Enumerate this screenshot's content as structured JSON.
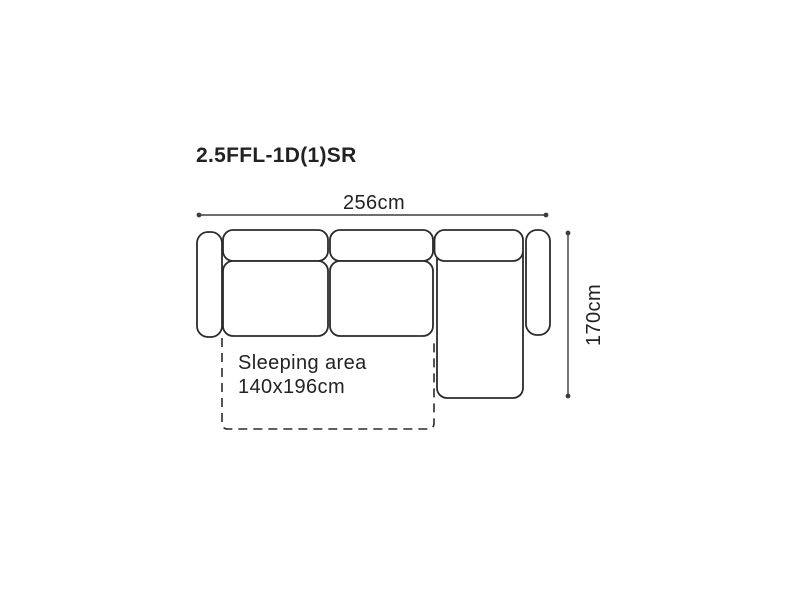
{
  "colors": {
    "background": "#ffffff",
    "outline": "#2b2b2b",
    "dimension": "#3d3d3d",
    "text": "#222222"
  },
  "diagram": {
    "model_code": "2.5FFL-1D(1)SR",
    "width_dimension": "256cm",
    "depth_dimension": "170cm",
    "sleeping_area_label": "Sleeping area",
    "sleeping_area_size": "140x196cm"
  }
}
